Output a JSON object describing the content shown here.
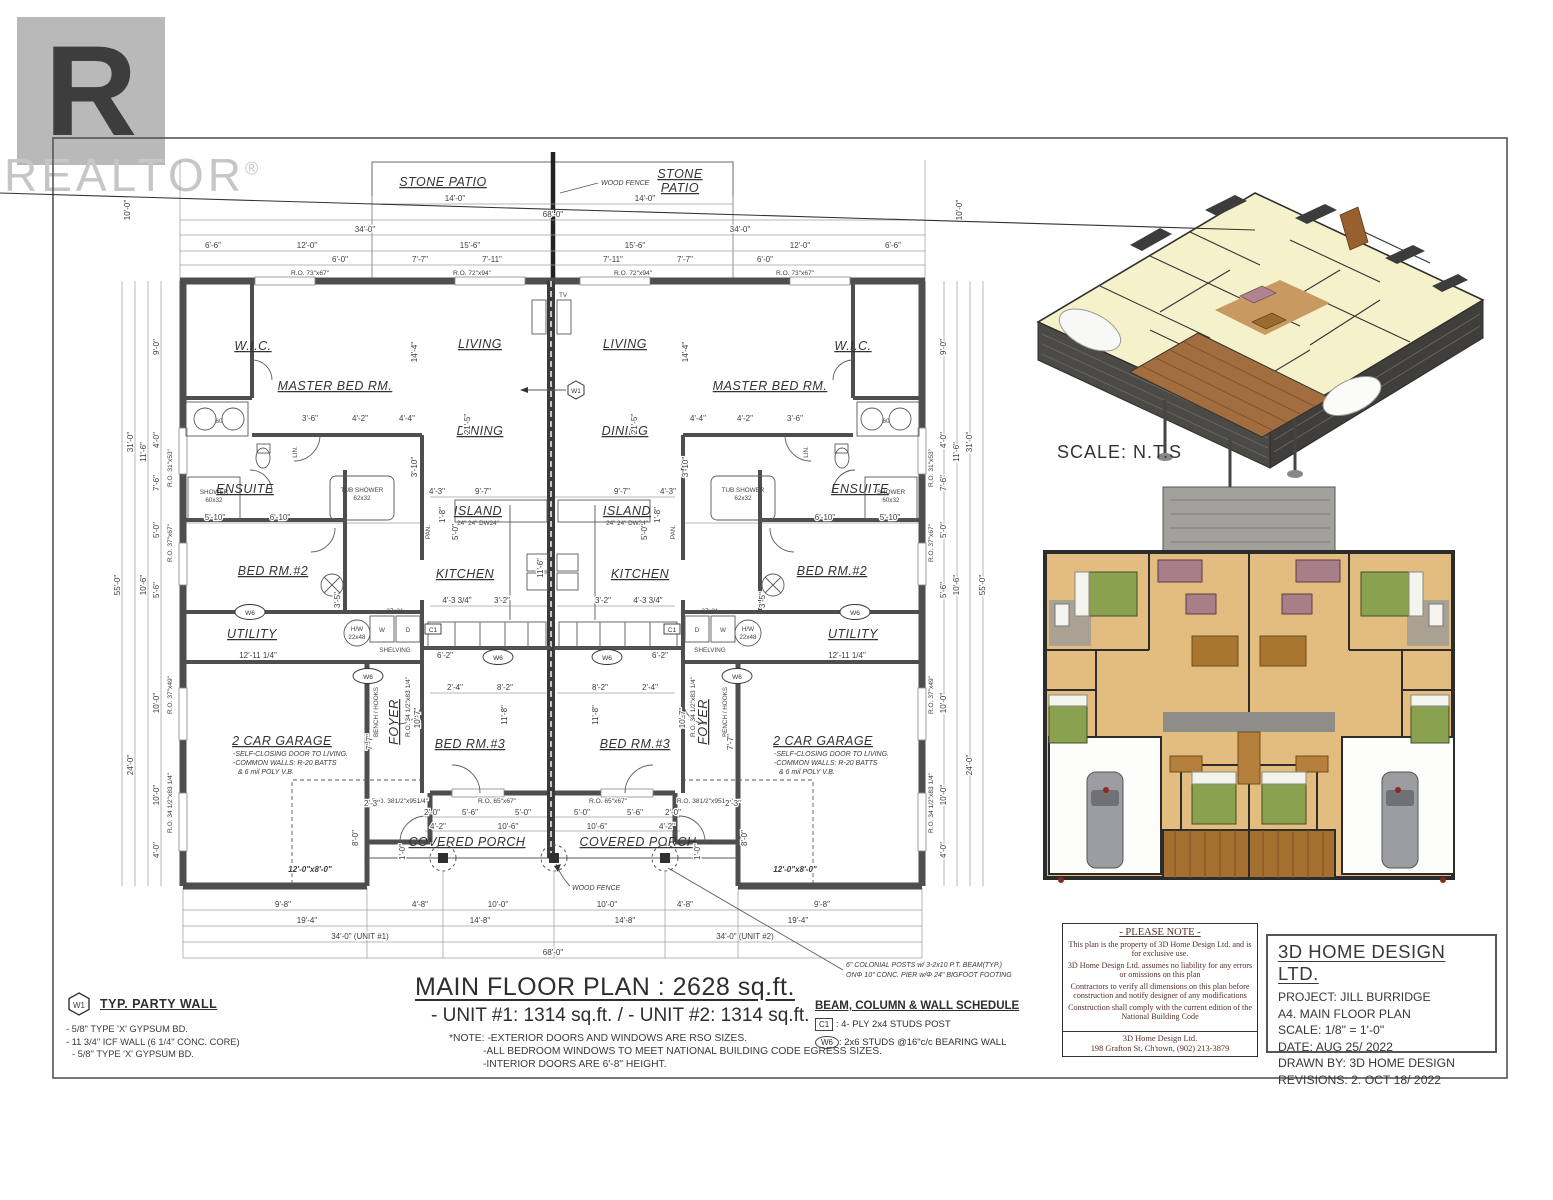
{
  "watermark": {
    "logo_letter": "R",
    "brand": "REALTOR",
    "reg": "®"
  },
  "site": {
    "patio": "STONE PATIO",
    "patio_a": "STONE",
    "patio_b": "PATIO",
    "fence": "WOOD FENCE"
  },
  "rooms": {
    "wic": "W.I.C.",
    "master": "MASTER BED RM.",
    "living": "LIVING",
    "dining": "DINING",
    "kitchen": "KITCHEN",
    "island": "ISLAND",
    "island_base": "24\" 24\" DW24\"",
    "ensuite": "ENSUITE",
    "bed2": "BED RM.#2",
    "bed3": "BED RM.#3",
    "utility": "UTILITY",
    "garage": "2 CAR GARAGE",
    "gnote1": "-SELF-CLOSING DOOR TO LIVING.",
    "gnote2": "-COMMON WALLS: R-20  BATTS",
    "gnote3": "& 6 mil POLY V.B.",
    "foyer": "FOYER",
    "bench": "BENCH / HOOKS",
    "porch": "COVERED PORCH",
    "pan": "PAN.",
    "lin": "LIN.",
    "tv": "TV",
    "tub1": "TUB SHOWER",
    "tub2": "62x32",
    "shower": "SHOWER",
    "shower2": "60x32",
    "hw1": "H/W",
    "hw2": "22x48",
    "shelving": "SHELVING",
    "w": "W",
    "d": "D",
    "wd": "27x31",
    "sixty": "60"
  },
  "markers": {
    "w1": "W1",
    "w6": "W6",
    "c1": "C1"
  },
  "dims": {
    "d14": "14'-0\"",
    "d68": "68'-0\"",
    "d34": "34'-0\"",
    "d6_6": "6'-6\"",
    "d12": "12'-0\"",
    "d15_6": "15'-6\"",
    "d6": "6'-0\"",
    "d7_7": "7'-7\"",
    "d7_11": "7'-11\"",
    "d10": "10'-0\"",
    "d9": "9'-0\"",
    "d31": "31'-0\"",
    "d55": "55'-0\"",
    "d4": "4'-0\"",
    "d11_6": "11'-6\"",
    "d7_6": "7'-6\"",
    "d5": "5'-0\"",
    "d10_6": "10'-6\"",
    "d5_6": "5'-6\"",
    "d24": "24'-0\"",
    "d9_8": "9'-8\"",
    "d19_4": "19'-4\"",
    "d34u1": "34'-0\" (UNIT #1)",
    "d34u2": "34'-0\" (UNIT #2)",
    "d4_8": "4'-8\"",
    "d14_8": "14'-8\"",
    "d4_2": "4'-2\"",
    "d2_0": "2'-0\"",
    "d8_0": "8'-0\"",
    "d1_0": "1'-0\"",
    "d2_3": "2'-3\"",
    "d21_5": "21'-5\"",
    "d14_4": "14'-4\"",
    "d3_10": "3'-10\"",
    "d9_7": "9'-7\"",
    "d4_3": "4'-3\"",
    "d3_6": "3'-6\"",
    "d4_4": "4'-4\"",
    "d5_10": "5'-10\"",
    "d6_10": "6'-10\"",
    "d12_11": "12'-11 1/4\"",
    "d6_2": "6'-2\"",
    "d8_2": "8'-2\"",
    "d2_4": "2'-4\"",
    "d10_7": "10'-7\"",
    "d11_8": "11'-8\"",
    "d3_5": "3'-5\"",
    "d4_33": "4'-3 3/4\"",
    "d3_2": "3'-2\"",
    "d1_8": "1'-8\"",
    "gdoor": "12'-0\"x8'-0\""
  },
  "ro": {
    "r7367": "R.O. 73\"x67\"",
    "r7294": "R.O. 72\"x94\"",
    "r3153": "R.O. 31\"x53\"",
    "r3767": "R.O. 37\"x67\"",
    "r3749": "R.O. 37\"x49\"",
    "r3483": "R.O. 34 1/2\"x83 1/4\"",
    "r381": "R.O. 381/2\"x951/4\"",
    "r6567": "R.O. 65\"x67\""
  },
  "posts_note": {
    "l1": "6\" COLONIAL POSTS w/ 3-2x10 P.T. BEAM(TYP.)",
    "l2": "ONΦ 10\" CONC. PIER w/Φ 24\" BIGFOOT FOOTING"
  },
  "main_title": {
    "title": "MAIN FLOOR PLAN : 2628 sq.ft.",
    "subtitle": "- UNIT #1: 1314 sq.ft. / - UNIT #2: 1314 sq.ft.",
    "note1": "*NOTE: -EXTERIOR DOORS AND WINDOWS ARE RSO SIZES.",
    "note2": "-ALL BEDROOM WINDOWS TO MEET NATIONAL BUILDING CODE EGRESS SIZES.",
    "note3": "-INTERIOR DOORS ARE 6'-8\" HEIGHT."
  },
  "schedule": {
    "title": "BEAM, COLUMN & WALL SCHEDULE",
    "c1_tag": "C1",
    "c1_desc": ": 4- PLY 2x4 STUDS POST",
    "w6_tag": "W6",
    "w6_desc": ": 2x6 STUDS @16\"c/c BEARING WALL"
  },
  "party_wall": {
    "tag": "W1",
    "title": "TYP. PARTY WALL",
    "l1": "- 5/8\" TYPE 'X' GYPSUM BD.",
    "l2": "- 11 3/4\" ICF WALL (6 1/4\" CONC. CORE)",
    "l3": "- 5/8\" TYPE 'X' GYPSUM BD."
  },
  "render_3d": {
    "scale": "SCALE: N.T.S"
  },
  "please_note": {
    "title": "- PLEASE NOTE -",
    "p1": "This plan is the property of  3D Home Design Ltd. and is for exclusive use.",
    "p2": "3D Home Design Ltd. assumes no liability for any errors or omissions on this plan",
    "p3": "Contractors to verify all dimensions on this plan before construction and notify designer of any modifications",
    "p4": "Construction shall comply with the current edition of the National Building Code",
    "f1": "3D Home Design Ltd.",
    "f2": "198 Grafton St. Ch'town, (902) 213-3879"
  },
  "title_block": {
    "company": "3D HOME DESIGN LTD.",
    "project": "PROJECT: JILL BURRIDGE",
    "sheet": "A4. MAIN FLOOR PLAN",
    "scale": "SCALE: 1/8\" = 1'-0\"",
    "date": "DATE: AUG 25/ 2022",
    "drawn_by": "DRAWN BY: 3D HOME DESIGN",
    "revisions": "REVISIONS: 2. OCT 18/ 2022"
  }
}
